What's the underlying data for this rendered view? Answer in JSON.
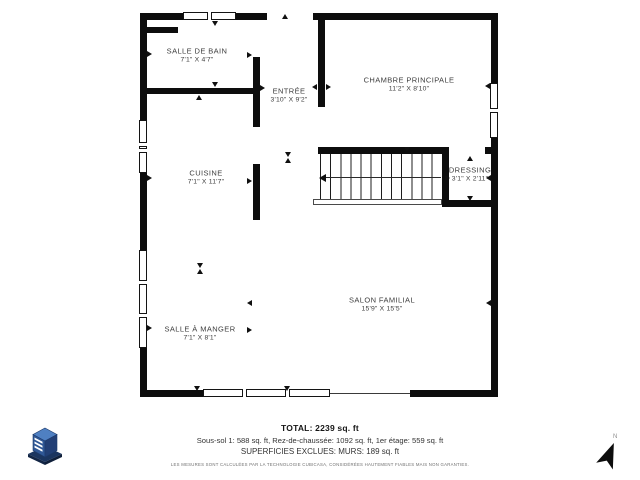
{
  "rooms": [
    {
      "name": "SALLE DE BAIN",
      "dims": "7'1\" X 4'7\""
    },
    {
      "name": "ENTRÉE",
      "dims": "3'10\" X 9'2\""
    },
    {
      "name": "CHAMBRE PRINCIPALE",
      "dims": "11'2\" X 8'10\""
    },
    {
      "name": "CUISINE",
      "dims": "7'1\" X 11'7\""
    },
    {
      "name": "DRESSING",
      "dims": "3'1\" X 2'11\""
    },
    {
      "name": "SALON FAMILIAL",
      "dims": "15'9\" X 15'5\""
    },
    {
      "name": "SALLE À MANGER",
      "dims": "7'1\" X 8'1\""
    }
  ],
  "footer": {
    "total": "TOTAL: 2239 sq. ft",
    "floors": "Sous-sol 1: 588 sq. ft, Rez-de-chaussée: 1092 sq. ft, 1er étage: 559 sq. ft",
    "excluded": "SUPERFICIES EXCLUES: MURS: 189 sq. ft",
    "disclaimer": "LES MESURES SONT CALCULÉES PAR LA TECHNOLOGIE CUBICASA, CONSIDÉRÉES HAUTEMENT FIABLES MAIS NON GARANTIES."
  },
  "compass": {
    "label": "N"
  },
  "icons": {
    "logo": "cubicasa-cube-logo",
    "north": "north-arrow-icon"
  },
  "colors": {
    "wall": "#0d0d0d",
    "label_text": "#3d3d3d",
    "logo_dark": "#16294f",
    "logo_mid": "#2f5795",
    "logo_light": "#4f80c2"
  }
}
